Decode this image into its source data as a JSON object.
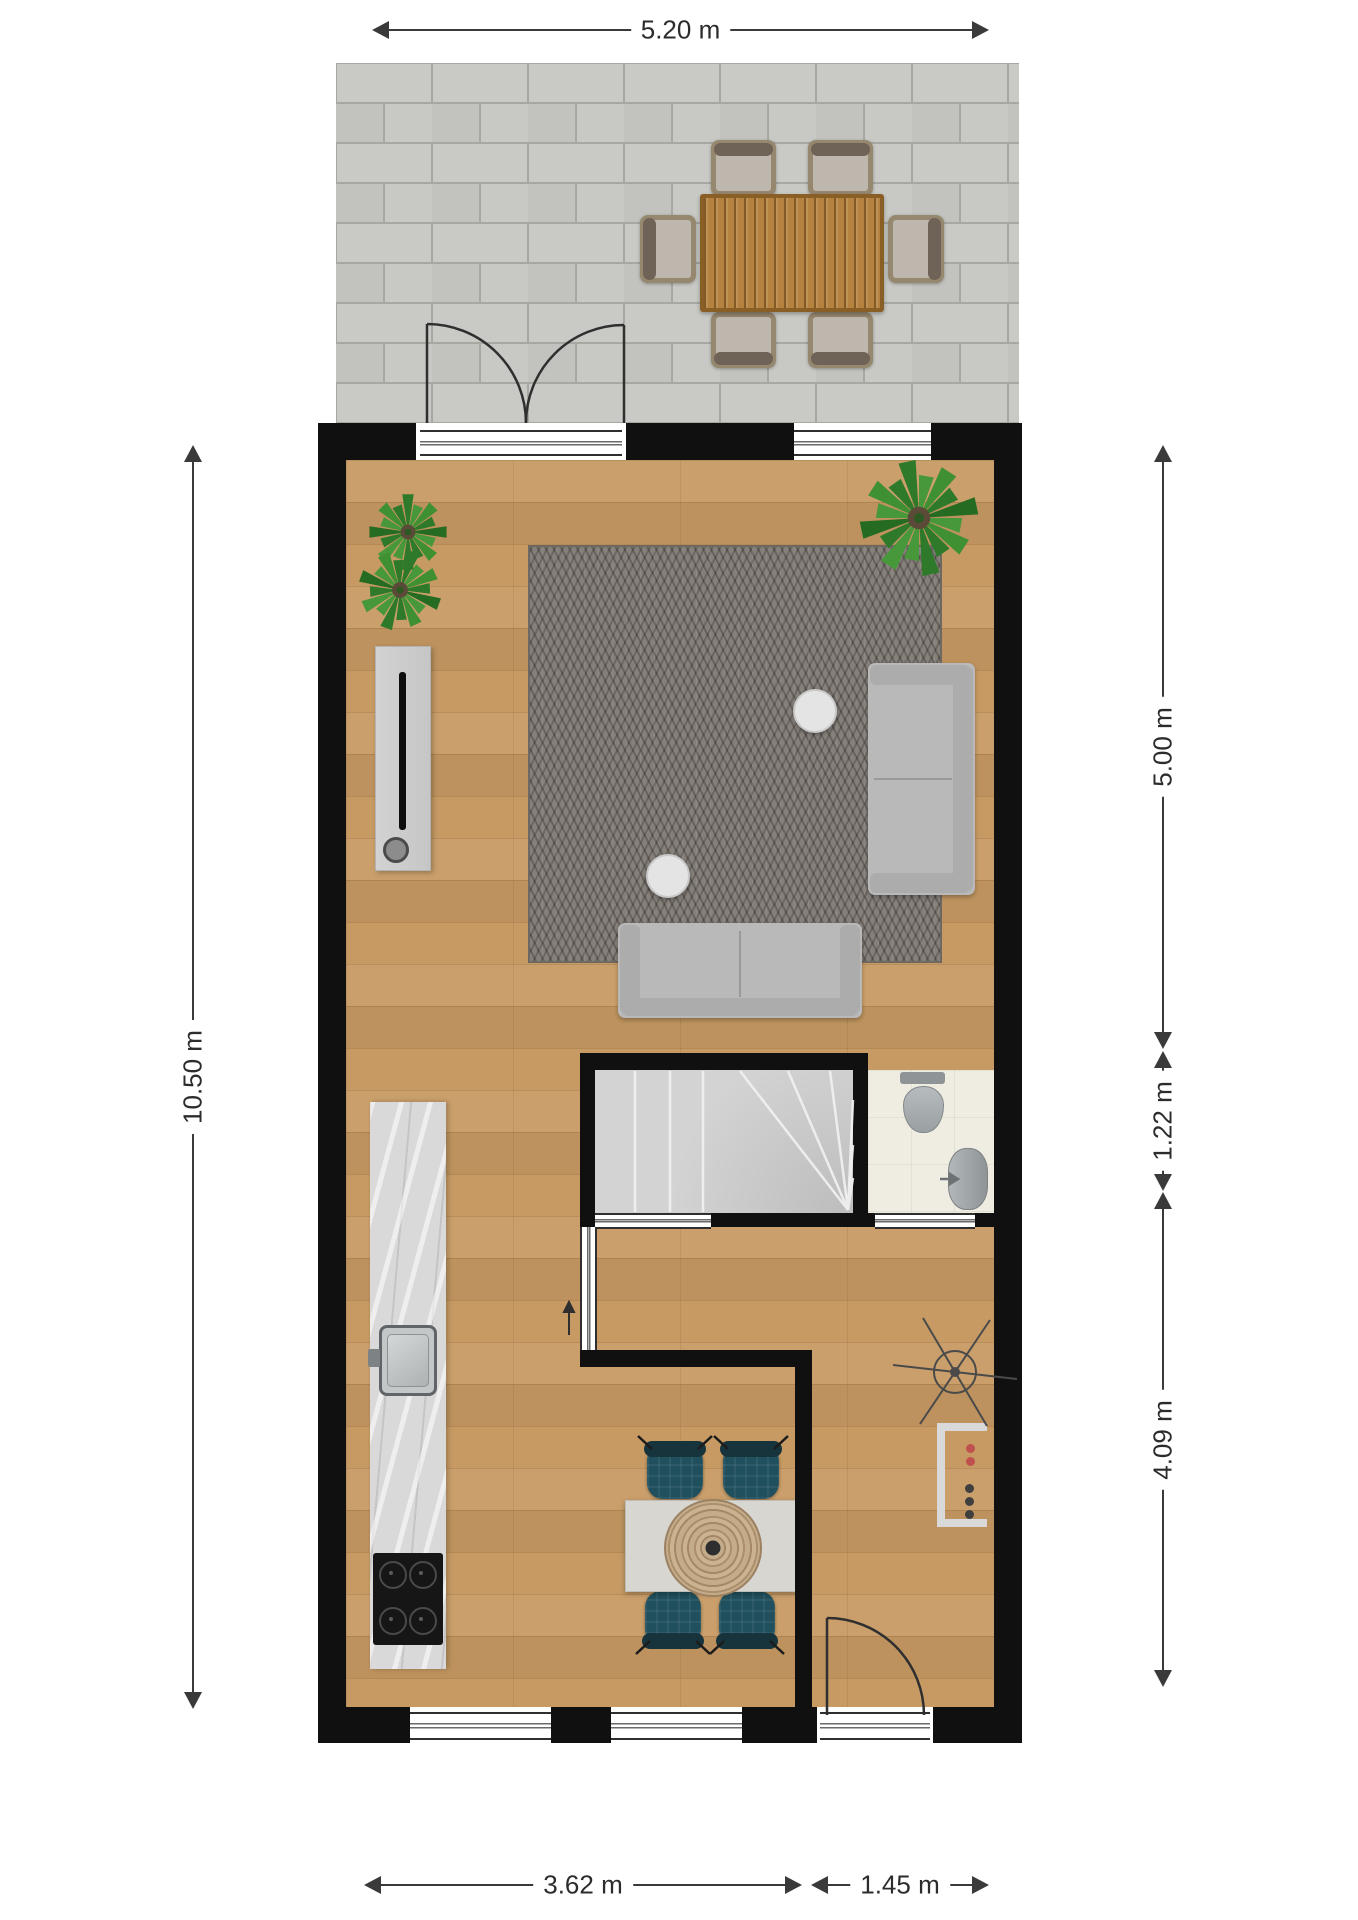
{
  "plan": {
    "title": "ground-floor-plan",
    "dims": {
      "top": "5.20 m",
      "left": "10.50 m",
      "right": [
        "5.00 m",
        "1.22 m",
        "4.09 m"
      ],
      "bottom": [
        "3.62 m",
        "1.45 m"
      ]
    },
    "palette": {
      "wall": "#101010",
      "wood_floor": "#c79a63",
      "terrace_tile": "#c6c7c2",
      "rug": "#7b746e",
      "sofa": "#b9b9b9",
      "stairs": "#d3d3d3",
      "wc_floor": "#efece1",
      "kitchen_counter": "#d9d9d9",
      "dining_chair": "#20505d",
      "patio_table": "#b5823f",
      "plant": "#2f7a2a",
      "dimension_line": "#3a3a3a",
      "radiator_dot_red": "#c0504d"
    }
  }
}
